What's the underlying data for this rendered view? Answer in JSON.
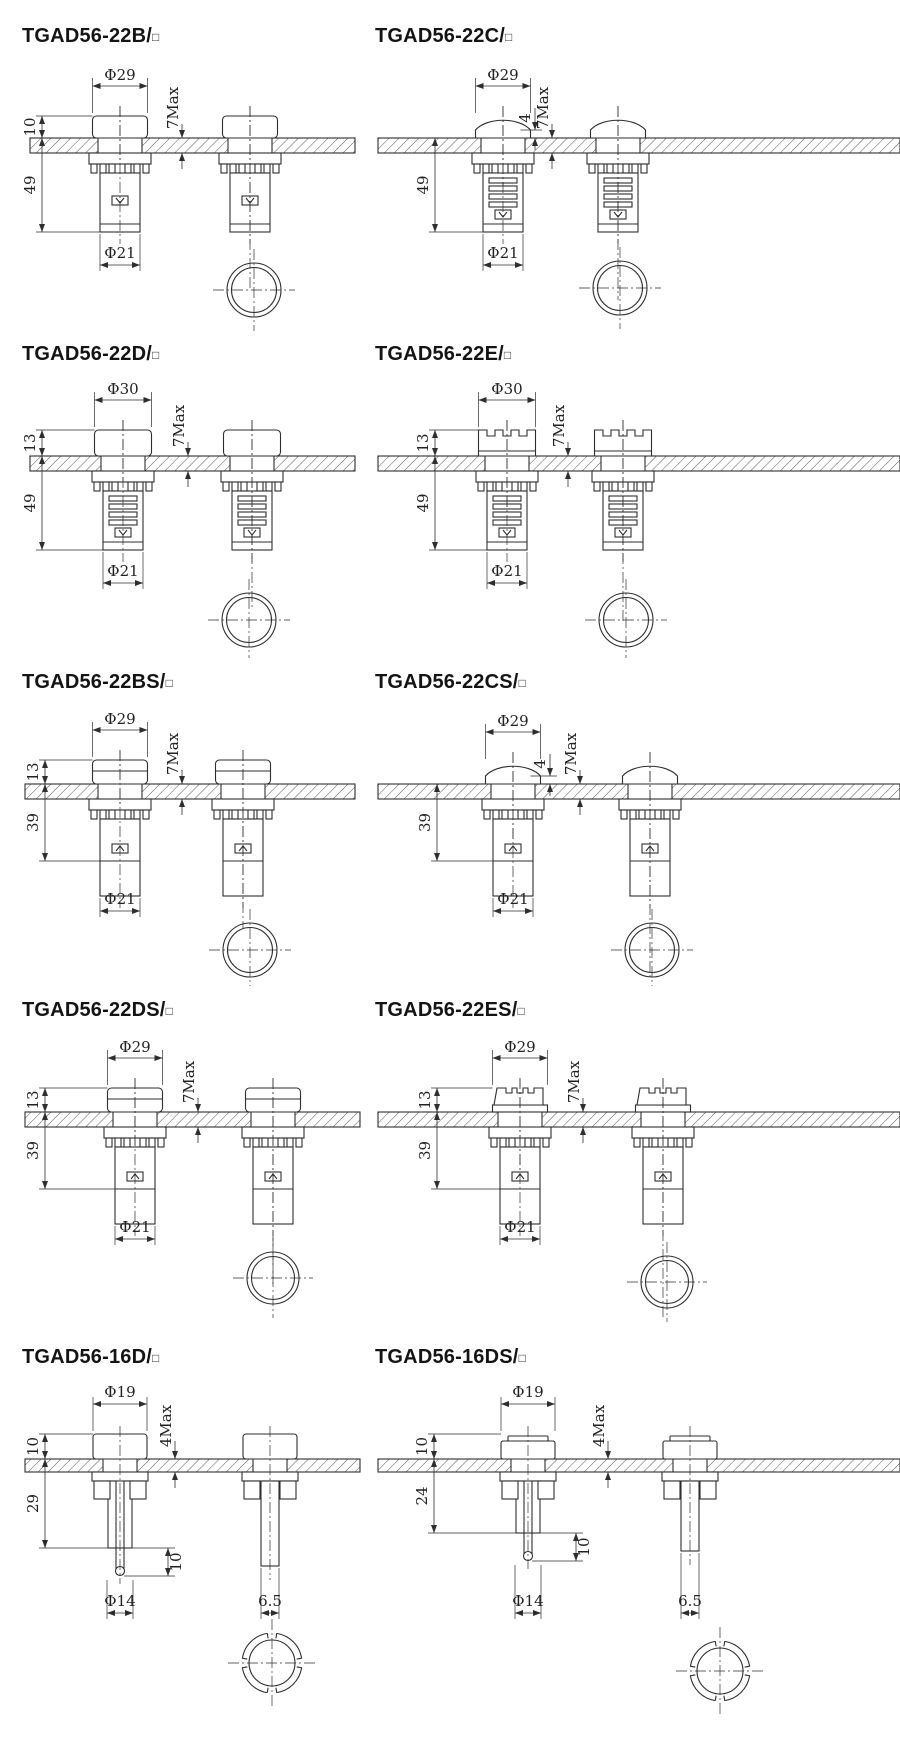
{
  "page": {
    "background": "#ffffff",
    "line_color": "#2e2e2e",
    "title_color": "#141414"
  },
  "panels": [
    {
      "model": "TGAD56-22B",
      "title_text": "TGAD56-22B/",
      "title_box": "□",
      "dims": {
        "top_diameter": "Φ29",
        "head_height": "10",
        "body_length": "49",
        "bottom_diameter": "Φ21",
        "panel_thickness_max": "7Max"
      }
    },
    {
      "model": "TGAD56-22C",
      "title_text": "TGAD56-22C/",
      "title_box": "□",
      "dims": {
        "top_diameter": "Φ29",
        "dome_height": "4",
        "body_length": "49",
        "bottom_diameter": "Φ21",
        "panel_thickness_max": "7Max"
      }
    },
    {
      "model": "TGAD56-22D",
      "title_text": "TGAD56-22D/",
      "title_box": "□",
      "dims": {
        "top_diameter": "Φ30",
        "head_height": "13",
        "body_length": "49",
        "bottom_diameter": "Φ21",
        "panel_thickness_max": "7Max"
      }
    },
    {
      "model": "TGAD56-22E",
      "title_text": "TGAD56-22E/",
      "title_box": "□",
      "dims": {
        "top_diameter": "Φ30",
        "head_height": "13",
        "body_length": "49",
        "bottom_diameter": "Φ21",
        "panel_thickness_max": "7Max"
      }
    },
    {
      "model": "TGAD56-22BS",
      "title_text": "TGAD56-22BS/",
      "title_box": "□",
      "dims": {
        "top_diameter": "Φ29",
        "head_height": "13",
        "body_length": "39",
        "bottom_diameter": "Φ21",
        "panel_thickness_max": "7Max"
      }
    },
    {
      "model": "TGAD56-22CS",
      "title_text": "TGAD56-22CS/",
      "title_box": "□",
      "dims": {
        "top_diameter": "Φ29",
        "dome_height": "4",
        "body_length": "39",
        "bottom_diameter": "Φ21",
        "panel_thickness_max": "7Max"
      }
    },
    {
      "model": "TGAD56-22DS",
      "title_text": "TGAD56-22DS/",
      "title_box": "□",
      "dims": {
        "top_diameter": "Φ29",
        "head_height": "13",
        "body_length": "39",
        "bottom_diameter": "Φ21",
        "panel_thickness_max": "7Max"
      }
    },
    {
      "model": "TGAD56-22ES",
      "title_text": "TGAD56-22ES/",
      "title_box": "□",
      "dims": {
        "top_diameter": "Φ29",
        "head_height": "13",
        "body_length": "39",
        "bottom_diameter": "Φ21",
        "panel_thickness_max": "7Max"
      }
    },
    {
      "model": "TGAD56-16D",
      "title_text": "TGAD56-16D/",
      "title_box": "□",
      "dims": {
        "top_diameter": "Φ19",
        "head_height": "10",
        "body_length": "29",
        "pin_length": "10",
        "bottom_diameter": "Φ14",
        "stem_width": "6.5",
        "panel_thickness_max": "4Max"
      }
    },
    {
      "model": "TGAD56-16DS",
      "title_text": "TGAD56-16DS/",
      "title_box": "□",
      "dims": {
        "top_diameter": "Φ19",
        "head_height": "10",
        "body_length": "24",
        "pin_length": "10",
        "bottom_diameter": "Φ14",
        "stem_width": "6.5",
        "panel_thickness_max": "4Max"
      }
    }
  ]
}
